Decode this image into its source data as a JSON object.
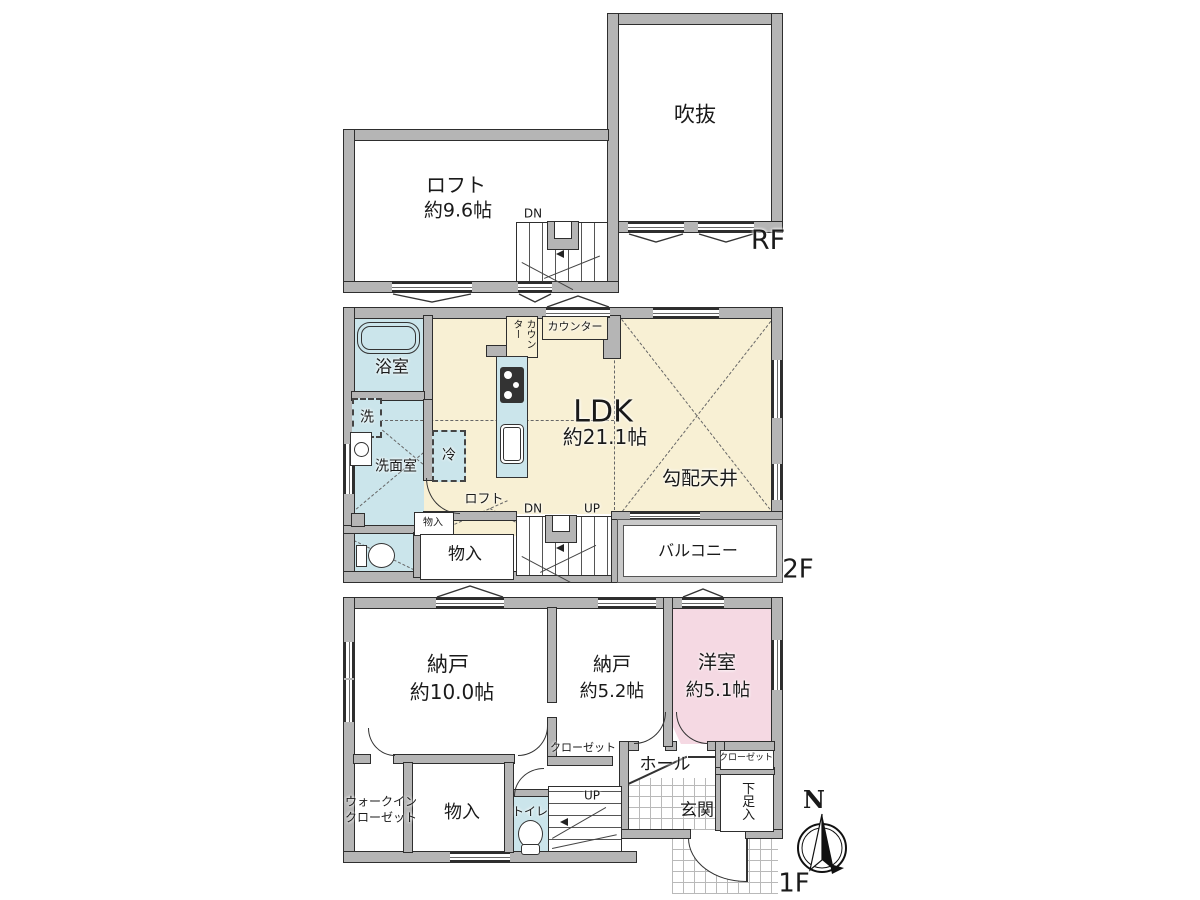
{
  "colors": {
    "wall_gray": "#b5b5b5",
    "floor_cream": "#f8f0d4",
    "wet_area_blue": "#cbe5eb",
    "room_pink": "#f5d9e3"
  },
  "rf": {
    "floor_label": "RF",
    "void_room": "吹抜",
    "loft": "ロフト",
    "loft_size": "約9.6帖",
    "dn": "DN"
  },
  "f2": {
    "floor_label": "2F",
    "bath": "浴室",
    "laundry": "洗",
    "washroom": "洗面室",
    "fridge": "冷",
    "counter_vertical": "カウンター",
    "counter": "カウンター",
    "ldk": "LDK",
    "ldk_size": "約21.1帖",
    "sloped_ceiling": "勾配天井",
    "loft_above": "ロフト",
    "storage_small": "物入",
    "storage": "物入",
    "dn": "DN",
    "up": "UP",
    "balcony": "バルコニー"
  },
  "f1": {
    "floor_label": "1F",
    "storage_room_1": "納戸",
    "storage_room_1_size": "約10.0帖",
    "storage_room_2": "納戸",
    "storage_room_2_size": "約5.2帖",
    "western_room": "洋室",
    "western_room_size": "約5.1帖",
    "closet_left": "クローゼット",
    "closet_right": "クローゼット",
    "hall": "ホール",
    "entrance": "玄関",
    "shoe_box": "下足入",
    "wic_line1": "ウォークイン",
    "wic_line2": "クローゼット",
    "storage": "物入",
    "toilet": "トイレ",
    "up": "UP"
  },
  "compass": {
    "north": "N"
  }
}
